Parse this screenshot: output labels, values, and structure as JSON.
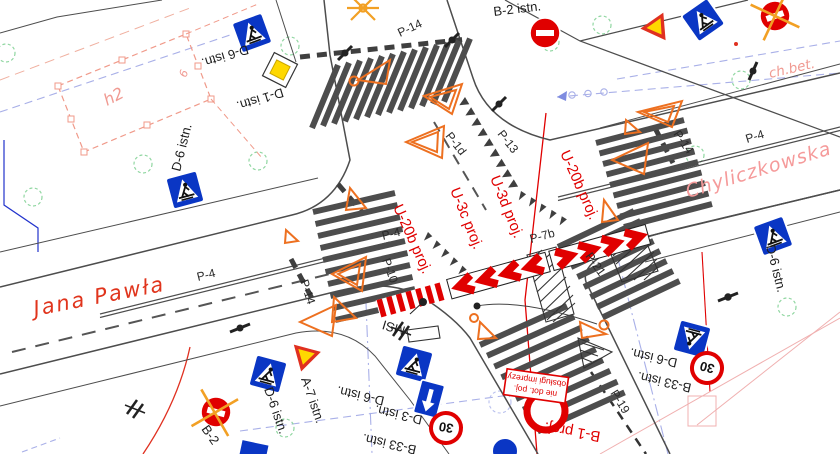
{
  "title": "Traffic organization plan - intersection",
  "streets": {
    "jana_pawla": "Jana Pawła",
    "chyliczkowska": "Chyliczkowska",
    "sidewalk_note": "ch.bet.",
    "building_label": "h2",
    "utility_label": "6",
    "msi": "MSI"
  },
  "road_markings": {
    "p4": "P-4",
    "p14": "P-14",
    "p13": "P-13",
    "p1d": "P-1d",
    "p10": "P-10",
    "p7b": "P-7b",
    "p19": "P-19",
    "p21": "P-21"
  },
  "signs_existing": {
    "d6": "D-6 istn.",
    "d1": "D-1 istn.",
    "b2": "B-2 istn.",
    "b2_short": "B-2",
    "a7": "A-7 istn.",
    "d3": "D-3 istn.",
    "b33": "B-33 istn.",
    "b33_value": "30"
  },
  "signs_project": {
    "u20b": "U-20b proj.",
    "u3c": "U-3c proj.",
    "u3d": "U-3d proj.",
    "b1": "B-1 proj.",
    "plate_line1": "nie dot. poj.",
    "plate_line2": "obsługi imprezy"
  },
  "colors": {
    "project_red": "#e00000",
    "existing_black": "#1c1c1c",
    "street_red": "#e0341c",
    "street_pink": "#f59a9a",
    "sign_blue": "#0a36c4",
    "sign_yellow": "#ffd800",
    "barrier_orange": "#ed7020",
    "removal_orange": "#f2a024",
    "tree_green": "#8fd6a0",
    "utility_lavender": "#a9b0e8",
    "asphalt_line_gray": "#4d4d4d"
  }
}
